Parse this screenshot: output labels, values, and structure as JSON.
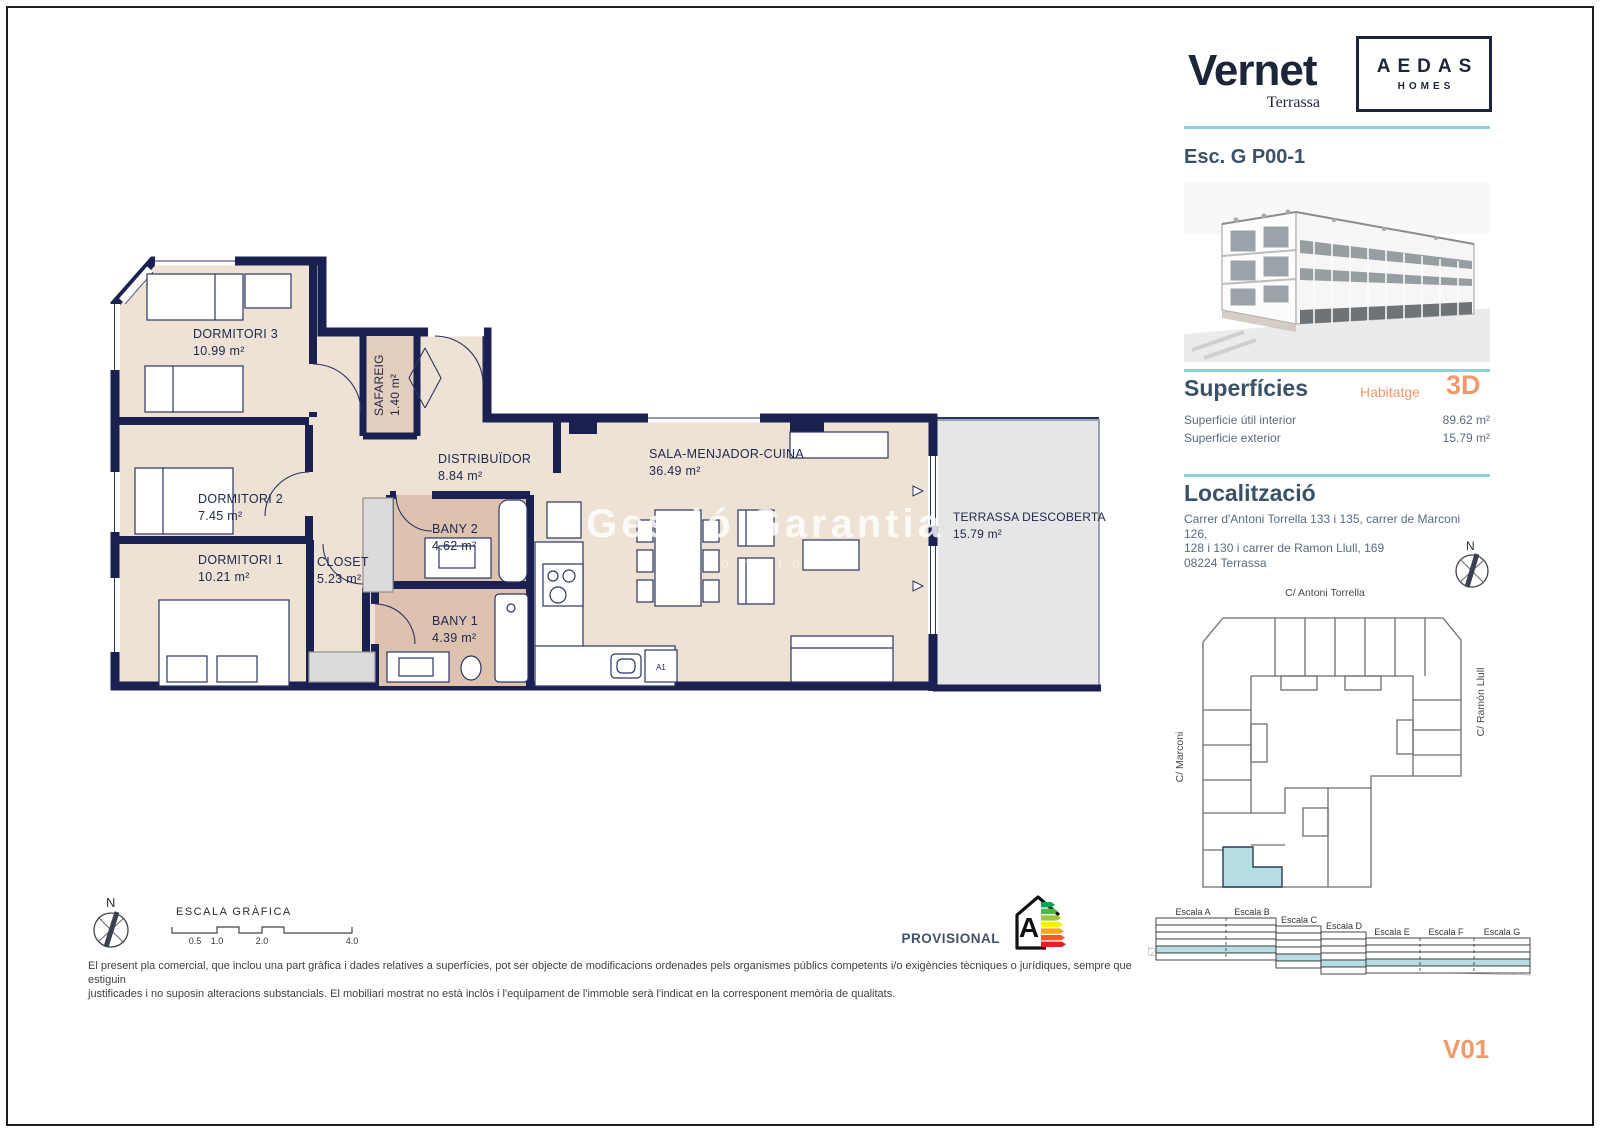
{
  "header": {
    "project_name": "Vernet",
    "project_subtitle": "Terrassa",
    "brand_top": "AEDAS",
    "brand_bottom": "HOMES",
    "unit_title": "Esc. G P00-1"
  },
  "superficies": {
    "title": "Superfícies",
    "dwelling_label": "Habitatge",
    "dwelling_code": "3D",
    "rows": [
      {
        "label": "Superficie útil interior",
        "value": "89.62 m²"
      },
      {
        "label": "Superficie exterior",
        "value": "15.79 m²"
      }
    ]
  },
  "localitzacio": {
    "title": "Localització",
    "address_line1": "Carrer d'Antoni Torrella 133 i 135, carrer de Marconi 126,",
    "address_line2": "128 i 130 i carrer de Ramon Llull, 169",
    "address_line3": "08224 Terrassa",
    "street_top": "C/ Antoni Torrella",
    "street_left": "C/ Marconi",
    "street_right": "C/ Ramón Llull"
  },
  "floor_plan": {
    "rooms": [
      {
        "name": "DORMITORI 3",
        "area": "10.99 m²"
      },
      {
        "name": "SAFAREIG",
        "area": "1.40 m²"
      },
      {
        "name": "DISTRIBUÏDOR",
        "area": "8.84 m²"
      },
      {
        "name": "DORMITORI 2",
        "area": "7.45 m²"
      },
      {
        "name": "DORMITORI 1",
        "area": "10.21 m²"
      },
      {
        "name": "CLOSET",
        "area": "5.23 m²"
      },
      {
        "name": "BANY 2",
        "area": "4.62 m²"
      },
      {
        "name": "BANY 1",
        "area": "4.39 m²"
      },
      {
        "name": "SALA-MENJADOR-CUINA",
        "area": "36.49 m²"
      },
      {
        "name": "TERRASSA DESCOBERTA",
        "area": "15.79 m²"
      }
    ],
    "appliance_label": "A1"
  },
  "compass": {
    "label": "N"
  },
  "watermark": {
    "line1": "Gestió Garantia",
    "line2": "promotors"
  },
  "scale_bar": {
    "title": "ESCALA GRÀFICA",
    "ticks": [
      "0.5",
      "1.0",
      "2.0",
      "4.0"
    ]
  },
  "section_diagram": {
    "labels": [
      "Escala A",
      "Escala B",
      "Escala C",
      "Escala D",
      "Escala E",
      "Escala F",
      "Escala G"
    ]
  },
  "footer": {
    "provisional": "PROVISIONAL",
    "energy_rating": "A",
    "disclaimer_line1": "El present pla comercial, que inclou una part gràfica i dades relatives a superfícies, pot ser objecte de modificacions ordenades pels organismes públics competents i/o exigències tècniques o jurídiques, sempre que estiguin",
    "disclaimer_line2": "justificades i no suposin alteracions substancials. El mobiliari mostrat no està inclòs i l'equipament de l'immoble serà l'indicat en la corresponent memòria de qualitats.",
    "version": "V01"
  },
  "colors": {
    "wall_navy": "#1A2150",
    "floor_beige": "#EDE2D4",
    "bath_tan": "#DCC2AF",
    "terrace_gray": "#E6E6E6",
    "accent_teal": "#8FD0D3",
    "accent_orange": "#F09A6B",
    "highlight_teal": "#B5DDE3",
    "heading_blue": "#3A5268"
  }
}
